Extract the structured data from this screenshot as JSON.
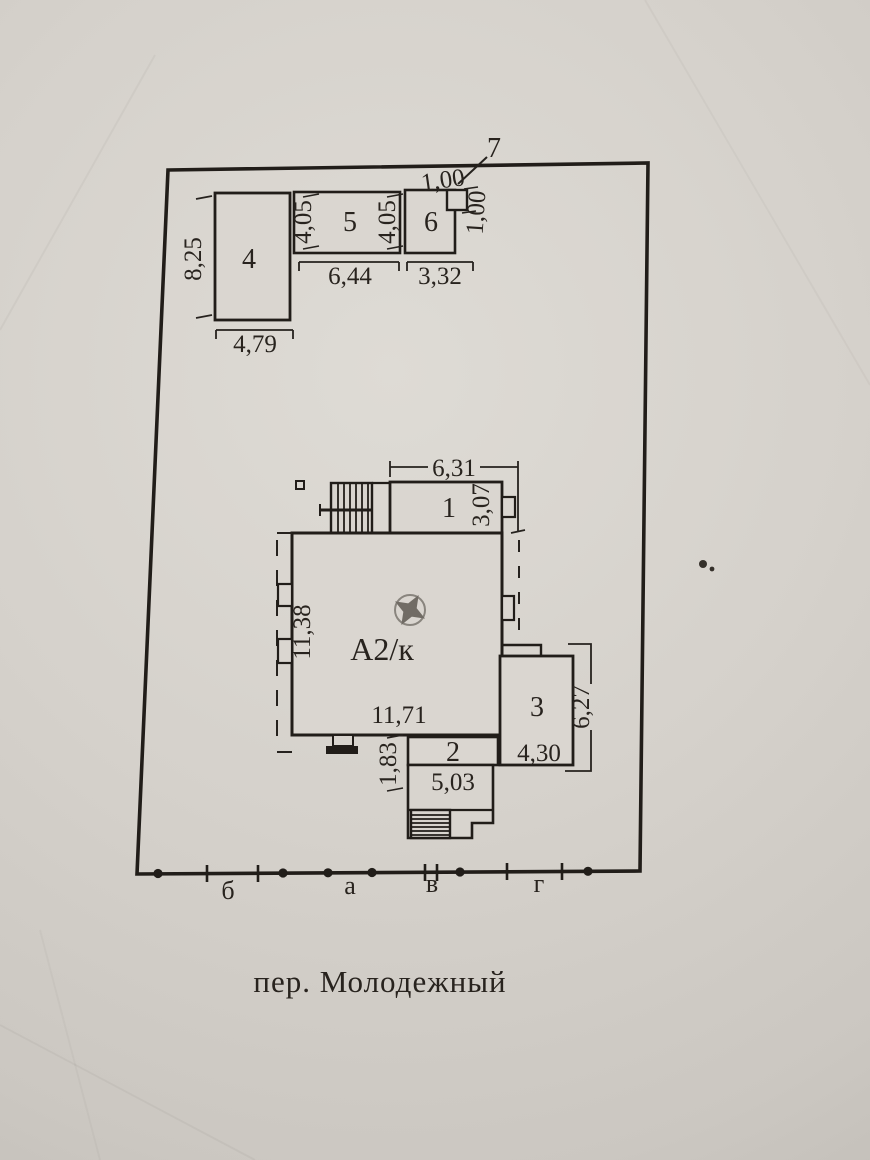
{
  "document": {
    "street_label": "пер. Молодежный",
    "axes": [
      "б",
      "а",
      "в",
      "г"
    ],
    "labels": {
      "b1": "1",
      "b2": "2",
      "b3": "3",
      "b4": "4",
      "b5": "5",
      "b6": "6",
      "b7": "7",
      "main": "А2/к"
    },
    "dims": {
      "b4_h": "8,25",
      "b4_w": "4,79",
      "b5_h_left": "4,05",
      "b5_h_right": "4,05",
      "b5_w": "6,44",
      "b6_w": "3,32",
      "b7_w": "1,00",
      "b7_h": "1,00",
      "b1_w": "6,31",
      "b1_h": "3,07",
      "main_h": "11,38",
      "main_w": "11,71",
      "b2_h": "1,83",
      "b2_w": "5,03",
      "b3_w": "4,30",
      "b3_h": "6,27"
    },
    "colors": {
      "ink": "#26221e",
      "paper": "#d6d2cc"
    }
  }
}
